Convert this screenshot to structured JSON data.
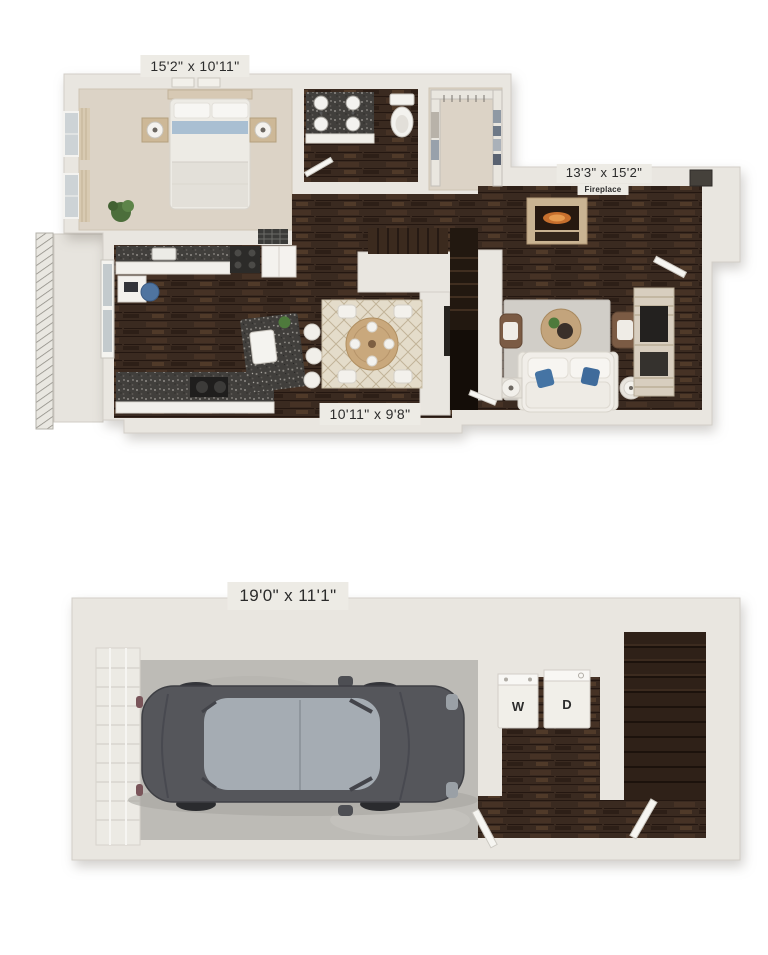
{
  "image_type": "two-level 3D apartment floor plan rendering",
  "floors": {
    "upper": {
      "labels": {
        "bedroom_dim": "15'2\" x 10'11\"",
        "living_dim": "13'3\" x 15'2\"",
        "fireplace": "Fireplace",
        "dining_dim": "10'11\" x 9'8\""
      },
      "rooms": [
        "bedroom",
        "bathroom",
        "walk-in closet",
        "hallway with stairs",
        "kitchen",
        "dining area",
        "living room",
        "balcony"
      ]
    },
    "lower": {
      "labels": {
        "garage_dim": "19'0\" x 11'1\"",
        "washer": "W",
        "dryer": "D"
      },
      "rooms": [
        "garage",
        "laundry nook",
        "stairwell"
      ]
    }
  },
  "colors": {
    "background": "#ffffff",
    "wall": "#e9e6e0",
    "wall_edge": "#d2cec7",
    "label_bg": "#edebe5",
    "label_text": "#2b2b2b",
    "hardwood": "#3a2a20",
    "carpet": "#dcd3c6",
    "granite": "#413f3c",
    "garage_concrete": "#bdbbb6",
    "car_body": "#55565b",
    "car_glass": "#a5acb3",
    "sofa_white": "#f1eee9",
    "accent_pillow_blue": "#4574a4",
    "accent_chair_brown": "#7b5b44",
    "flame_orange": "#c76f2d"
  }
}
